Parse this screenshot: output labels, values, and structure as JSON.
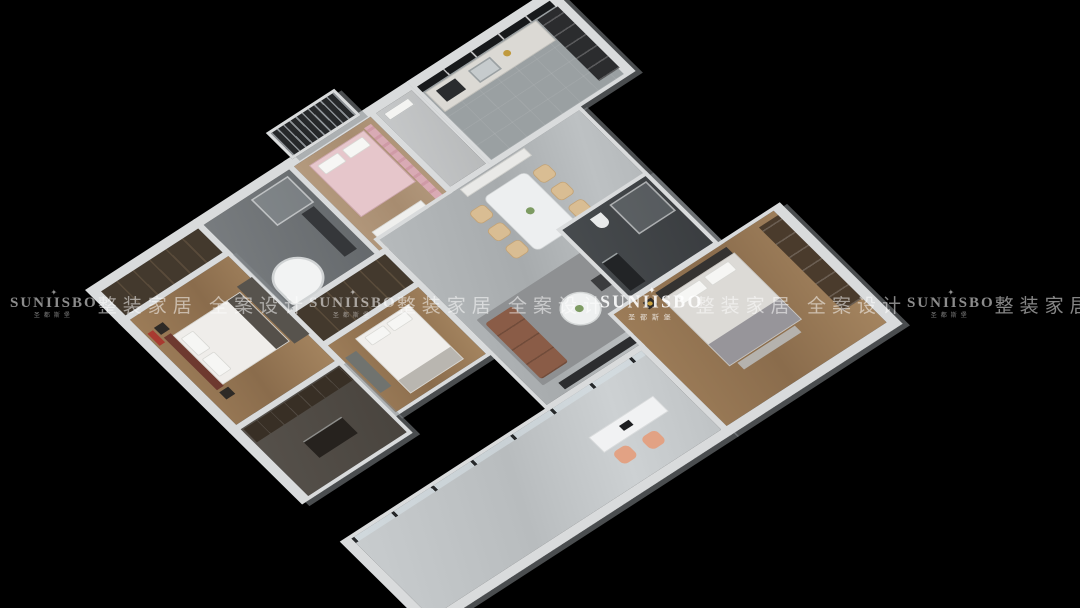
{
  "scene": {
    "description": "3D isometric interior render of a three-bedroom apartment floor plan on a black background",
    "background_color": "#000000",
    "wall_color": "#d9dbdc",
    "accent_colors": {
      "wood_floor": "#9c7c58",
      "marble_floor": "#b6babc",
      "sofa_leather": "#8a5c47",
      "kids_pink": "#e6c6cb",
      "master_red": "#a83a30",
      "dining_chair_beige": "#d9bd93",
      "balcony_chair_peach": "#e2a284"
    }
  },
  "watermark": {
    "color": "#ffffff",
    "items": [
      {
        "type": "logo",
        "ornament": "✦",
        "text": "SUNIISBO",
        "subtext": "圣都斯堡"
      },
      {
        "type": "slogan",
        "text": "整装家居 全案设计"
      },
      {
        "type": "logo",
        "ornament": "✦",
        "text": "SUNIISBO",
        "subtext": "圣都斯堡"
      },
      {
        "type": "slogan",
        "text": "整装家居 全案设计"
      },
      {
        "type": "logo",
        "ornament": "✦",
        "text": "SUNIISBO",
        "subtext": "圣都斯堡"
      },
      {
        "type": "slogan",
        "text": "整装家居 全案设计"
      },
      {
        "type": "logo",
        "ornament": "✦",
        "text": "SUNIISBO",
        "subtext": "圣都斯堡"
      },
      {
        "type": "slogan",
        "text": "整装家居 全案设计"
      }
    ]
  },
  "floorplan": {
    "rooms": [
      {
        "id": "master-wardrobe",
        "floor": "dark wood cabinets"
      },
      {
        "id": "master-bedroom",
        "floor": "wood",
        "items": [
          "bed with white duvet",
          "red headboard",
          "red wall art",
          "dark rug",
          "nightstands"
        ]
      },
      {
        "id": "bathroom-1",
        "floor": "grey stone",
        "items": [
          "round corner bathtub",
          "glass shower",
          "dark vanity"
        ]
      },
      {
        "id": "kids-bedroom",
        "floor": "light wood",
        "items": [
          "pink bed",
          "pink curtains",
          "white cabinet"
        ]
      },
      {
        "id": "north-balcony",
        "items": [
          "dark railing slats"
        ]
      },
      {
        "id": "entry",
        "items": [
          "entry door"
        ]
      },
      {
        "id": "kitchen",
        "floor": "grey tile",
        "items": [
          "counter with sink",
          "dark window band",
          "tall dark cabinet",
          "gold dish"
        ]
      },
      {
        "id": "closet-2",
        "floor": "dark wood cabinets"
      },
      {
        "id": "bedroom-2",
        "floor": "wood",
        "items": [
          "white bed",
          "grey desk"
        ]
      },
      {
        "id": "master-closet",
        "floor": "dark",
        "items": [
          "cabinet run",
          "island dresser"
        ]
      },
      {
        "id": "great-room",
        "floor": "grey marble",
        "items": [
          "dining table",
          "six beige chairs",
          "sideboard",
          "grey rug",
          "leather sofa",
          "armchair",
          "round coffee table",
          "two dark ottomans",
          "tv cabinet"
        ]
      },
      {
        "id": "bathroom-2",
        "floor": "dark stone",
        "items": [
          "glass shower",
          "dark vanity",
          "toilet"
        ]
      },
      {
        "id": "bedroom-3",
        "floor": "wood",
        "items": [
          "bed with grey throw",
          "bench",
          "wood wardrobe with mirror doors",
          "lamp"
        ]
      },
      {
        "id": "south-balcony",
        "floor": "light marble",
        "items": [
          "glass door wall",
          "white desk",
          "laptop",
          "two peach chairs"
        ]
      }
    ]
  }
}
